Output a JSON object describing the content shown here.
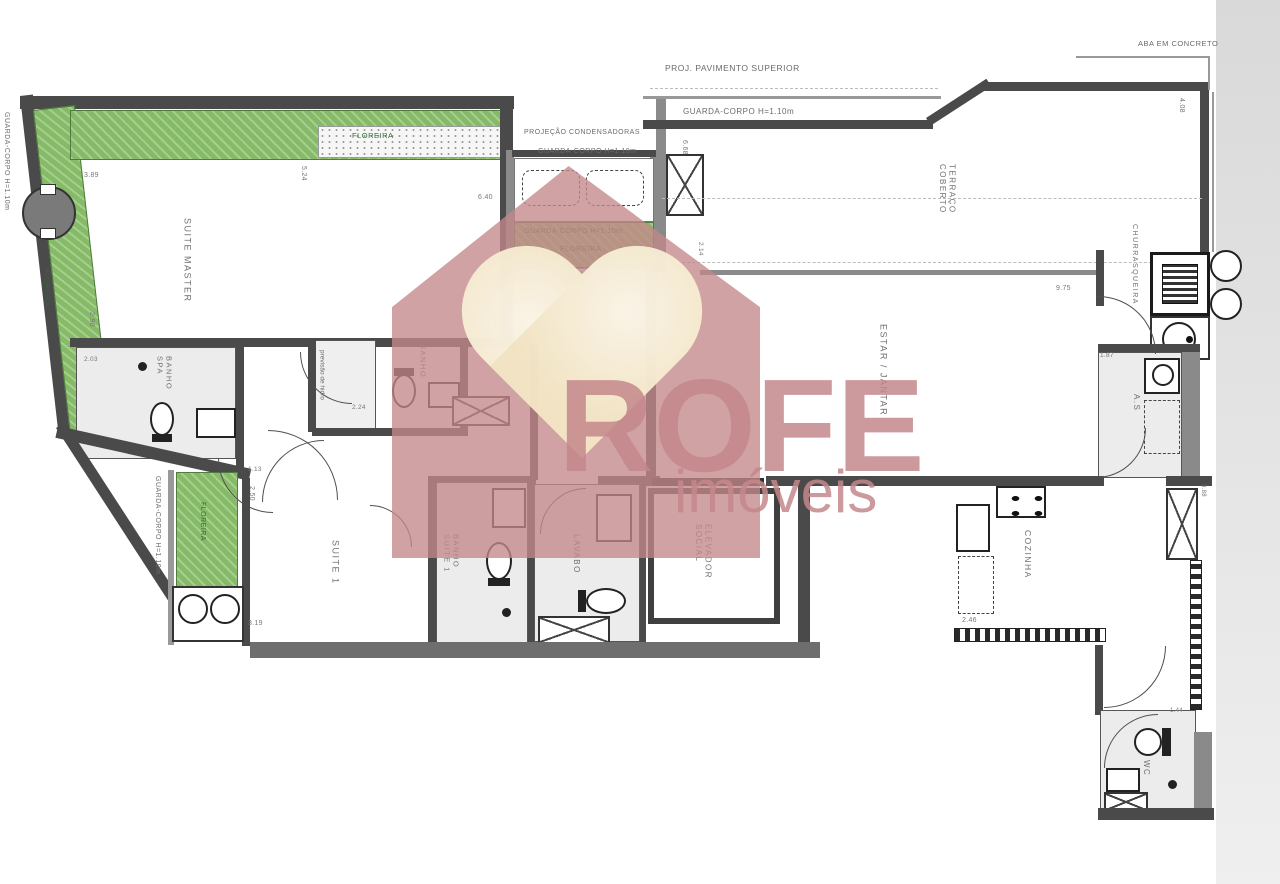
{
  "colors": {
    "wall": "#4a4a4a",
    "wall_light": "#8a8a8a",
    "floreira_green": "#85ba66",
    "floreira_text": "#2f6d2f",
    "watermark_rose": "#c4888b",
    "watermark_cream": "#f6ecd2",
    "floor_gray": "#ececec",
    "dim_text": "#787878"
  },
  "watermark": {
    "brand": "ROFE",
    "subtitle": "imóveis"
  },
  "rooms": {
    "suite_master": "SUITE MASTER",
    "banho_spa": "BANHO SPA",
    "banho_master": "BANHO",
    "suite_1": "SUITE 1",
    "banho_suite_1": "BANHO SUITE 1",
    "lavabo": "LAVABO",
    "elevador_social": "ELEVADOR SOCIAL",
    "estar_jantar": "ESTAR / JANTAR",
    "terraco_coberto": "TERRAÇO COBERTO",
    "churrasqueira": "CHURRASQUEIRA",
    "area_servico": "A.S",
    "cozinha": "COZINHA",
    "wc": "WC"
  },
  "labels": {
    "guarda_corpo": "GUARDA-CORPO H=1.10m",
    "floreira": "FLOREIRA",
    "proj_pavimento_superior": "PROJ. PAVIMENTO SUPERIOR",
    "projecao_condensadoras": "PROJEÇÃO CONDENSADORAS",
    "aba_em_concreto": "ABA EM CONCRETO",
    "previsao_hidro": "previsão de hidro"
  },
  "dims": [
    "3.89",
    "5.24",
    "6.40",
    "2.90",
    "2.03",
    "2.24",
    "2.11",
    "7.44",
    "1.13",
    "2.50",
    "3.19",
    "3.65",
    "2.30",
    "2.50",
    "2.14",
    "6.68",
    "4.08",
    "9.75",
    "1.87",
    "2.46",
    "3.88",
    "1.44"
  ]
}
